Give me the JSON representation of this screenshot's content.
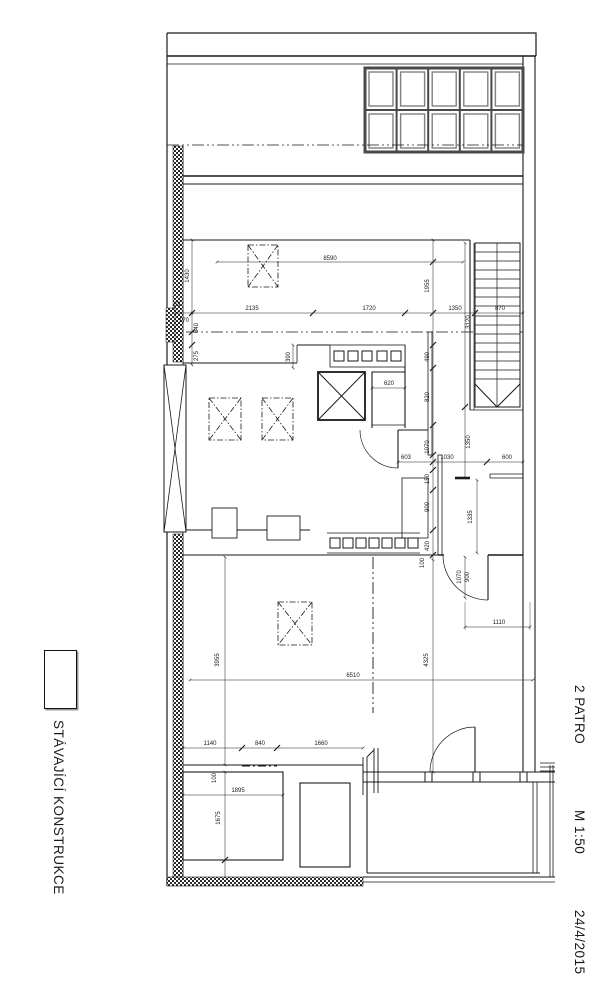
{
  "page": {
    "background": "#ffffff"
  },
  "title_block": {
    "floor": "2 PATRO",
    "scale": "M 1:50",
    "date": "24/4/2015"
  },
  "legend": {
    "existing_construction_label": "STÁVAJÍCÍ KONSTRUKCE",
    "swatch": "white-rectangle-outline"
  },
  "colors": {
    "line": "#1a1a1a",
    "wall_gray": "#555555",
    "glass_gray": "#808080"
  },
  "plan": {
    "dims": {
      "top_total": "8590",
      "bay1": "2135",
      "bay2": "1720",
      "bay3": "1350",
      "stair_width": "870",
      "left_a": "63",
      "left_b": "170",
      "left_c": "640",
      "left_d": "275",
      "terrace_left": "1430",
      "terrace_right": "1955",
      "parapet": "390",
      "stair_len": "3120",
      "v490": "490",
      "v820": "820",
      "closet": "620",
      "v1070": "1070",
      "v1350": "1350",
      "h603": "603",
      "h1030": "1030",
      "h600": "600",
      "v150": "150",
      "v900": "900",
      "v1335": "1335",
      "v420": "420",
      "v100a": "100",
      "door_1070": "1070",
      "door_900": "900",
      "h1110": "1110",
      "room_w": "6510",
      "room_h_left": "3955",
      "room_h_right": "4325",
      "b1140": "1140",
      "b840": "840",
      "b1660": "1660",
      "c100": "100",
      "c1895": "1895",
      "c1675": "1675"
    }
  }
}
